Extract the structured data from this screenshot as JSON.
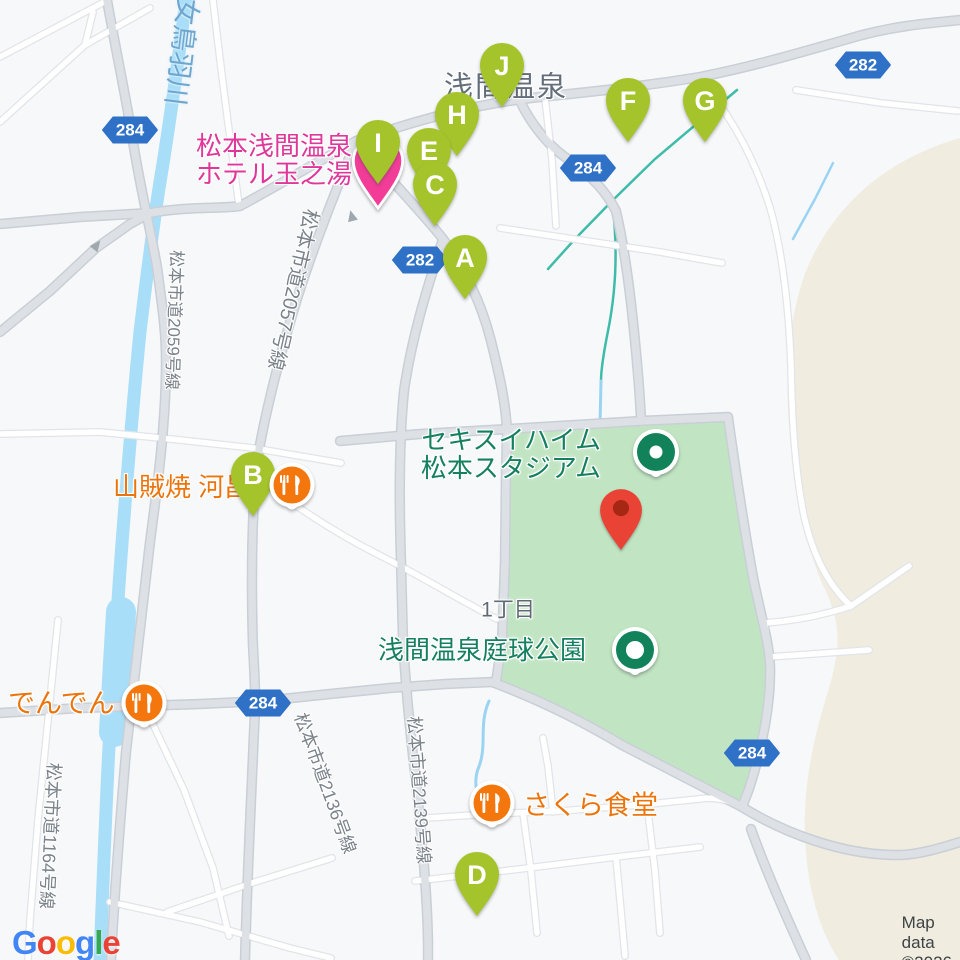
{
  "attribution": "Map data ©2026",
  "logo": [
    "G",
    "o",
    "o",
    "g",
    "l",
    "e"
  ],
  "logo_colors": [
    "#4285F4",
    "#EA4335",
    "#FBBC05",
    "#4285F4",
    "#34A853",
    "#EA4335"
  ],
  "area_labels": {
    "onsen_town": "浅間温泉",
    "chome": "1丁目"
  },
  "hotel": {
    "line1": "松本浅間温泉",
    "line2": "ホテル玉之湯"
  },
  "stadium": {
    "line1": "セキスイハイム",
    "line2": "松本スタジアム"
  },
  "tennis_park": "浅間温泉庭球公園",
  "restaurants": {
    "kawasho": "山賊焼 河昌",
    "denden": "でんでん",
    "sakura": "さくら食堂"
  },
  "river_name": "女鳥羽川",
  "road_names": {
    "r2059": "松本市道2059号線",
    "r2057": "松本市道2057号線",
    "r1164": "松本市道1164号線",
    "r2136": "松本市道2136号線",
    "r2139": "松本市道2139号線"
  },
  "route_badges": [
    "284",
    "282",
    "284",
    "282",
    "284",
    "284"
  ],
  "markers": [
    "A",
    "B",
    "C",
    "D",
    "E",
    "F",
    "G",
    "H",
    "I",
    "J"
  ],
  "icons": {
    "restaurant": "fork-knife-icon",
    "park": "park-dot-icon",
    "hotel": "hotel-pin-icon",
    "destination": "red-pin-icon",
    "oneway": "arrow-icon"
  },
  "colors": {
    "marker_green": "#A5C42C",
    "hotel_pink": "#F23C97",
    "restaurant_orange": "#F4770E",
    "park_icon_green": "#12825A",
    "park_fill": "#C1E5C2",
    "terrain_beige": "#F0ECDF",
    "water": "#A8DEF8",
    "badge_blue": "#2E71C6",
    "red_pin": "#E94335"
  }
}
